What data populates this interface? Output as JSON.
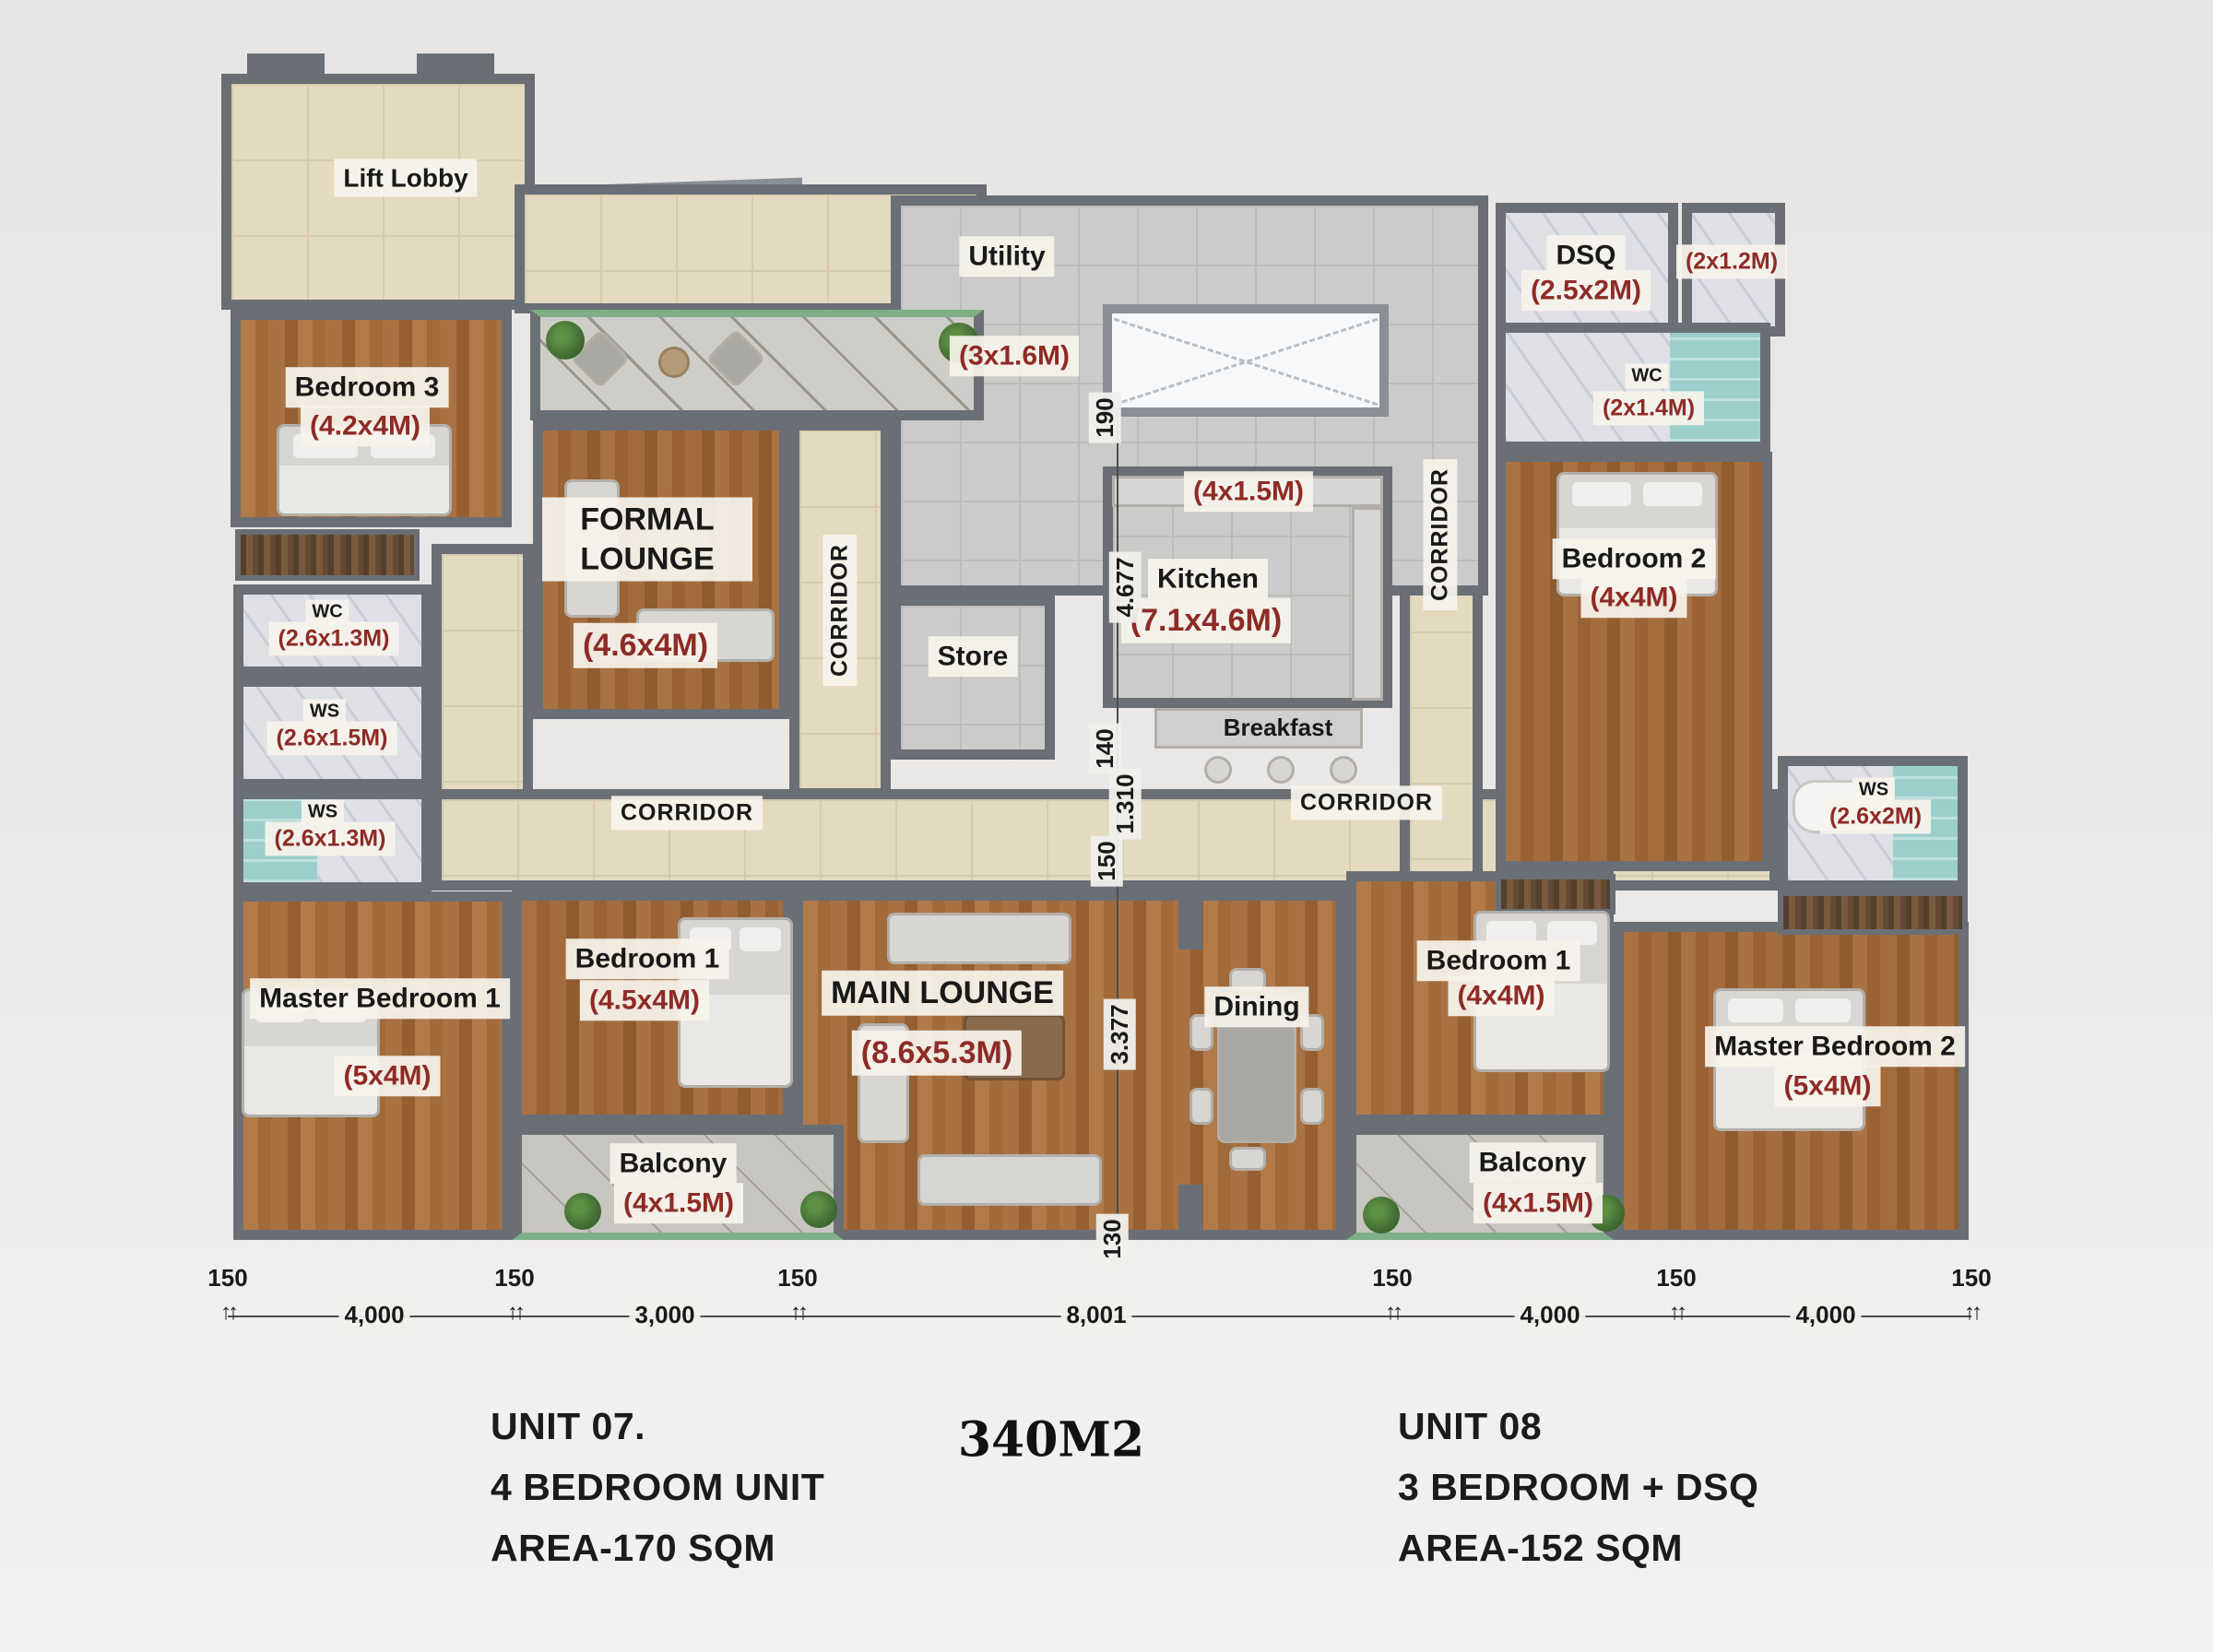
{
  "title": {
    "total_area": "340M2"
  },
  "units": {
    "unit07": {
      "title": "UNIT 07.",
      "subtitle": "4 BEDROOM UNIT",
      "area": "AREA-170 SQM"
    },
    "unit08": {
      "title": "UNIT 08",
      "subtitle": "3 BEDROOM + DSQ",
      "area": "AREA-152 SQM"
    }
  },
  "rooms": {
    "lift_lobby": {
      "label": "Lift Lobby"
    },
    "bedroom3": {
      "label": "Bedroom 3",
      "dim": "(4.2x4M)"
    },
    "formal_lounge": {
      "label": "FORMAL LOUNGE",
      "dim": "(4.6x4M)"
    },
    "utility": {
      "label": "Utility",
      "dim": "(3x1.6M)"
    },
    "store": {
      "label": "Store"
    },
    "kitchen": {
      "label": "Kitchen",
      "dim": "(7.1x4.6M)",
      "counter_dim": "(4x1.5M)"
    },
    "breakfast": {
      "label": "Breakfast"
    },
    "dsq": {
      "label": "DSQ",
      "dim": "(2.5x2M)"
    },
    "dsq_bath": {
      "dim": "(2x1.2M)"
    },
    "wc_unit8": {
      "label": "WC",
      "dim": "(2x1.4M)"
    },
    "bedroom2": {
      "label": "Bedroom 2",
      "dim": "(4x4M)"
    },
    "wc1": {
      "label": "WC",
      "dim": "(2.6x1.3M)"
    },
    "ws1": {
      "label": "WS",
      "dim": "(2.6x1.5M)"
    },
    "ws2": {
      "label": "WS",
      "dim": "(2.6x1.3M)"
    },
    "master_bedroom1": {
      "label": "Master Bedroom 1",
      "dim": "(5x4M)"
    },
    "bedroom1_u7": {
      "label": "Bedroom 1",
      "dim": "(4.5x4M)"
    },
    "balcony_u7": {
      "label": "Balcony",
      "dim": "(4x1.5M)"
    },
    "main_lounge": {
      "label": "MAIN LOUNGE",
      "dim": "(8.6x5.3M)"
    },
    "dining": {
      "label": "Dining"
    },
    "bedroom1_u8": {
      "label": "Bedroom 1",
      "dim": "(4x4M)"
    },
    "balcony_u8": {
      "label": "Balcony",
      "dim": "(4x1.5M)"
    },
    "ws_u8": {
      "label": "WS",
      "dim": "(2.6x2M)"
    },
    "master_bedroom2": {
      "label": "Master Bedroom 2",
      "dim": "(5x4M)"
    }
  },
  "corridor_label": "CORRIDOR",
  "dimensions": {
    "bottom": [
      "150",
      "4,000",
      "150",
      "3,000",
      "150",
      "8,001",
      "150",
      "4,000",
      "150",
      "4,000",
      "150"
    ],
    "vertical": [
      "190",
      "4.677",
      "140",
      "1.310",
      "150",
      "3.377",
      "130"
    ]
  },
  "colors": {
    "dimension_text": "#8e2b26",
    "wall": "#6a6f76",
    "wood_floor": "#a06838",
    "corridor_tile": "#e3dabf",
    "kitchen_tile": "#cbcbc9",
    "shower_glass": "#9ccfcb",
    "balcony_edge": "#7fae87"
  }
}
